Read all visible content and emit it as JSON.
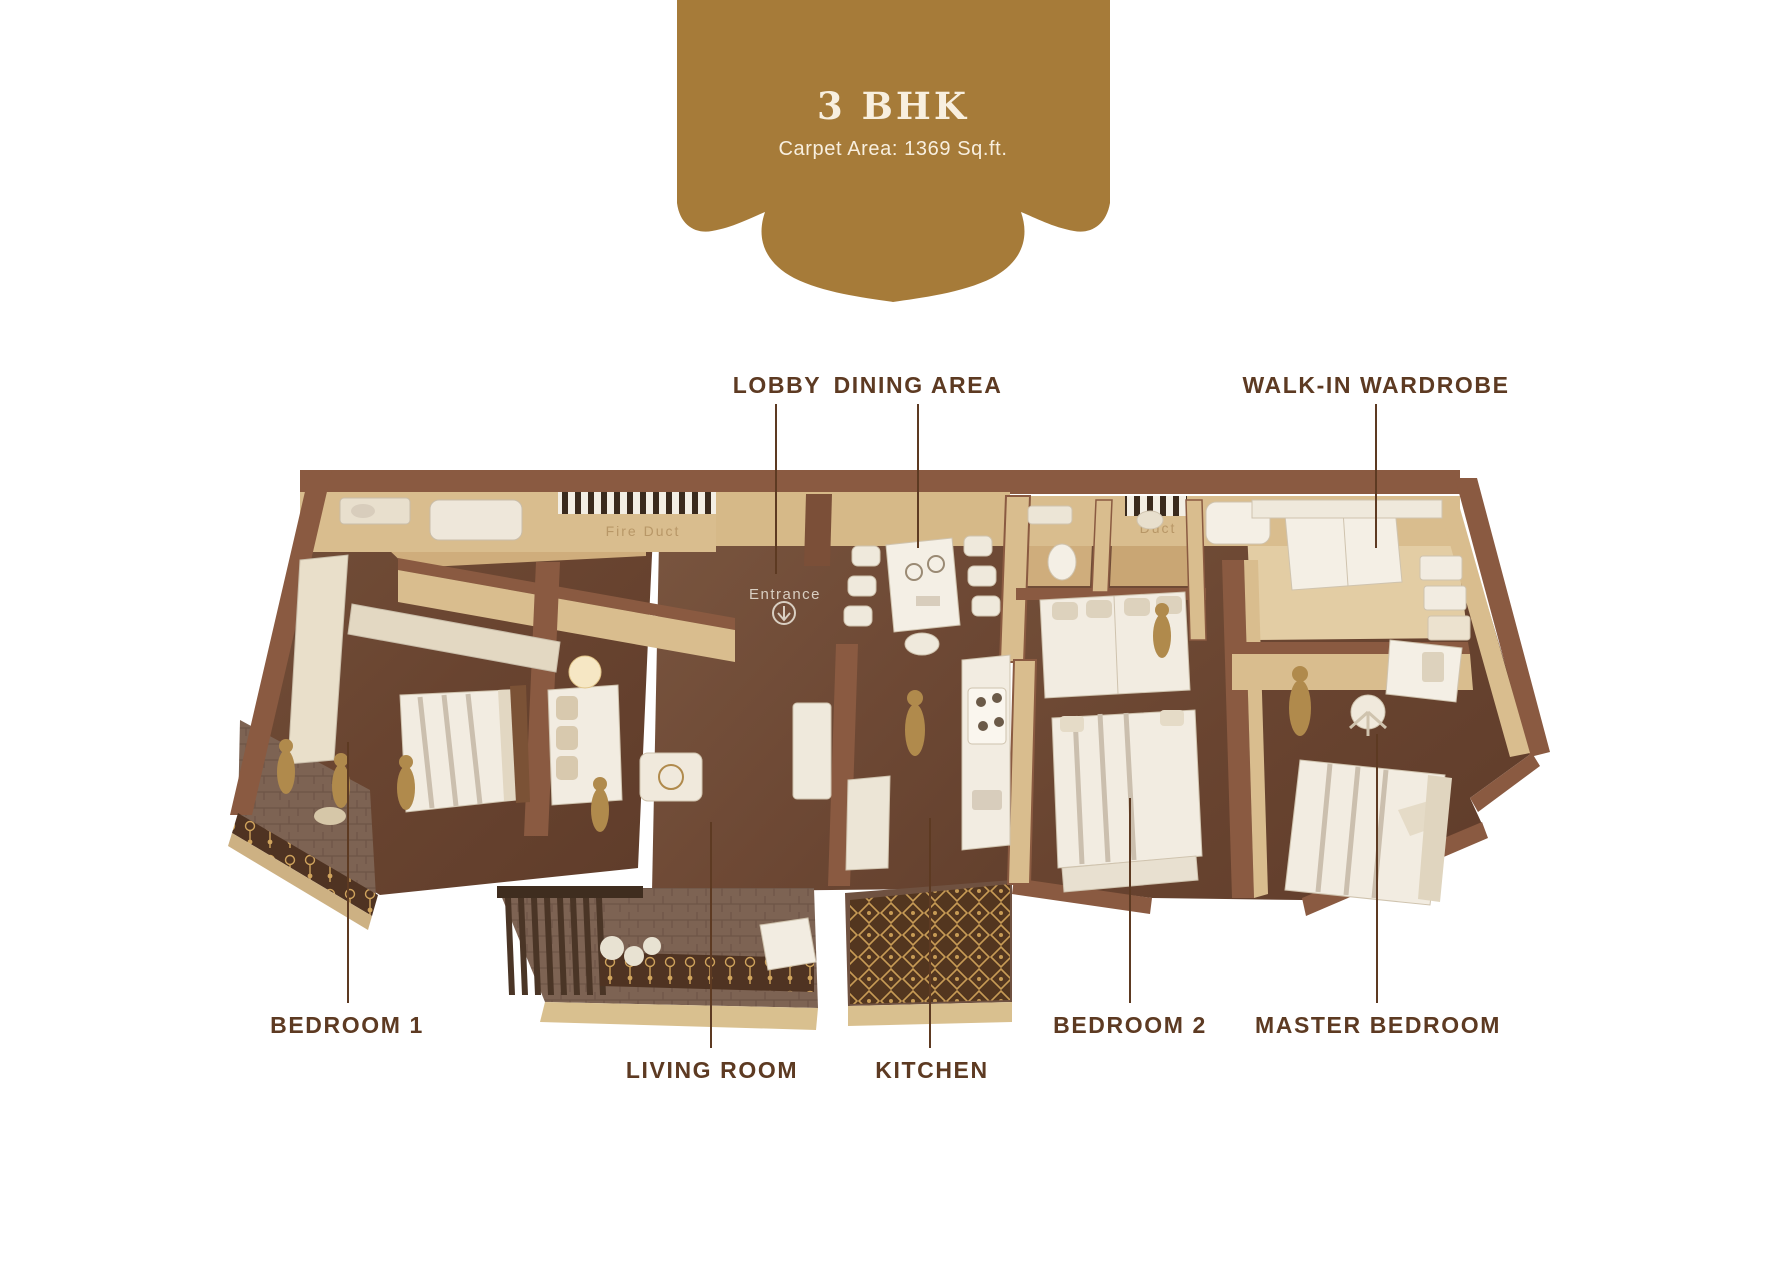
{
  "banner": {
    "title": "3 BHK",
    "subtitle": "Carpet Area: 1369 Sq.ft.",
    "background_color": "#a67b39",
    "text_color": "#f8efdf"
  },
  "floor_plan": {
    "room_labels": {
      "lobby": "LOBBY",
      "dining_area": "DINING AREA",
      "walk_in_wardrobe": "WALK-IN WARDROBE",
      "bedroom_1": "BEDROOM 1",
      "bedroom_2": "BEDROOM 2",
      "master_bedroom": "MASTER BEDROOM",
      "living_room": "LIVING ROOM",
      "kitchen": "KITCHEN"
    },
    "annotations": {
      "entrance": "Entrance",
      "duct_left": "Fire Duct",
      "duct_right": "Duct"
    },
    "label_color": "#5d3a22",
    "palette": {
      "floor_wood": "#6a4531",
      "wall_tan": "#d9bd8e",
      "wall_cap": "#8a5a41",
      "furniture_cream": "#f2ece1",
      "statue_gold": "#b08a4c",
      "balcony_floor": "#7c6150",
      "railing_dark": "#4f3322"
    }
  }
}
